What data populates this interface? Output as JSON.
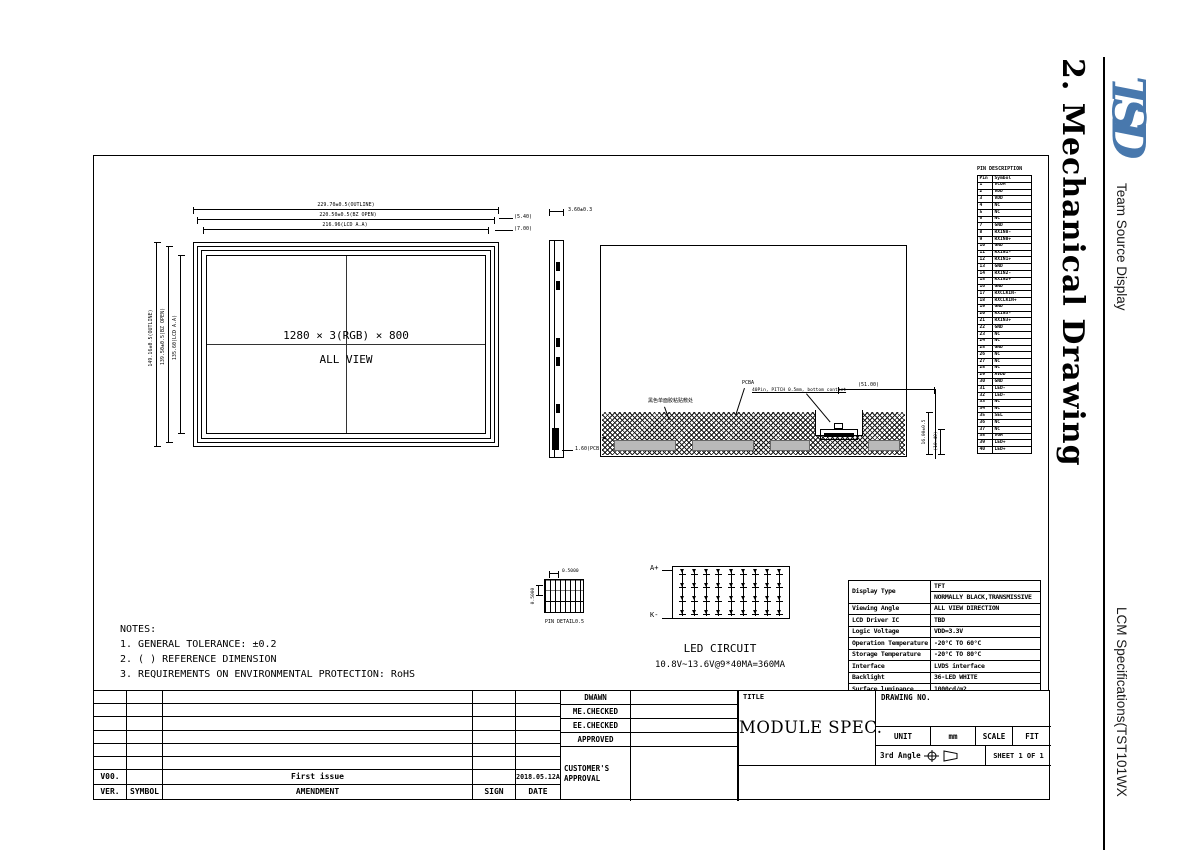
{
  "sidebar": {
    "section_title": "2. Mechanical Drawing",
    "logo_text": "TSD",
    "logo_color": "#4878ad",
    "company": "Team Source Display",
    "doc_title": "LCM Specifications(TST101WX"
  },
  "front_view": {
    "center_line1": "1280 × 3(RGB) × 800",
    "center_line2": "ALL VIEW",
    "dims_top": [
      "229.70±0.5(OUTLINE)",
      "220.50±0.5(BZ OPEN)",
      "216.96(LCD A.A)"
    ],
    "dims_left": [
      "149.16±0.5(OUTLINE)",
      "139.50±0.5(BZ OPEN)",
      "135.60(LCD A.A)"
    ],
    "dims_right": [
      "(5.40)",
      "(7.00)"
    ]
  },
  "side_view": {
    "dim_top": "3.60±0.3",
    "dim_bottom": "1.60(PCB)"
  },
  "back_view": {
    "label_tape": "黑色单面胶粘贴敷处",
    "label_pcba": "PCBA",
    "label_connector": "40Pin, PITCH 0.5mm, bottom contact",
    "dim_connector": "(51.00)",
    "dims_right": [
      "16.00±0.5",
      "(10.40)"
    ]
  },
  "pin_detail": {
    "dim_top": "0.5000",
    "dim_left": "0.5000",
    "caption": "PIN DETAIL0.5"
  },
  "led_circuit": {
    "anode": "A+",
    "cathode": "K-",
    "caption": "LED CIRCUIT",
    "spec": "10.8V~13.6V@9*40MA=360MA",
    "columns": [
      "",
      "",
      "",
      "",
      "",
      "",
      "",
      "",
      ""
    ]
  },
  "notes": {
    "heading": "NOTES:",
    "items": [
      "1. GENERAL TOLERANCE: ±0.2",
      "2. (  ) REFERENCE DIMENSION",
      "3.  REQUIREMENTS ON ENVIRONMENTAL PROTECTION: RoHS"
    ]
  },
  "pin_table": {
    "title": "PIN DESCRIPTION",
    "col_pin": "Pin",
    "col_symbol": "Symbol",
    "rows": [
      {
        "pin": "1",
        "symbol": "VCOM"
      },
      {
        "pin": "2",
        "symbol": "VDD"
      },
      {
        "pin": "3",
        "symbol": "VDD"
      },
      {
        "pin": "4",
        "symbol": "NC"
      },
      {
        "pin": "5",
        "symbol": "NC"
      },
      {
        "pin": "6",
        "symbol": "NC"
      },
      {
        "pin": "7",
        "symbol": "GND"
      },
      {
        "pin": "8",
        "symbol": "RXIN0-"
      },
      {
        "pin": "9",
        "symbol": "RXIN0+"
      },
      {
        "pin": "10",
        "symbol": "GND"
      },
      {
        "pin": "11",
        "symbol": "RXIN1-"
      },
      {
        "pin": "12",
        "symbol": "RXIN1+"
      },
      {
        "pin": "13",
        "symbol": "GND"
      },
      {
        "pin": "14",
        "symbol": "RXIN2-"
      },
      {
        "pin": "15",
        "symbol": "RXIN2+"
      },
      {
        "pin": "16",
        "symbol": "GND"
      },
      {
        "pin": "17",
        "symbol": "RXCLKIN-"
      },
      {
        "pin": "18",
        "symbol": "RXCLKIN+"
      },
      {
        "pin": "19",
        "symbol": "GND"
      },
      {
        "pin": "20",
        "symbol": "RXIN3-"
      },
      {
        "pin": "21",
        "symbol": "RXIN3+"
      },
      {
        "pin": "22",
        "symbol": "GND"
      },
      {
        "pin": "23",
        "symbol": "NC"
      },
      {
        "pin": "24",
        "symbol": "NC"
      },
      {
        "pin": "25",
        "symbol": "GND"
      },
      {
        "pin": "26",
        "symbol": "NC"
      },
      {
        "pin": "27",
        "symbol": "NC"
      },
      {
        "pin": "28",
        "symbol": "NC"
      },
      {
        "pin": "29",
        "symbol": "AVDD"
      },
      {
        "pin": "30",
        "symbol": "GND"
      },
      {
        "pin": "31",
        "symbol": "LED-"
      },
      {
        "pin": "32",
        "symbol": "LED-"
      },
      {
        "pin": "33",
        "symbol": "NC"
      },
      {
        "pin": "34",
        "symbol": "NC"
      },
      {
        "pin": "35",
        "symbol": "SEL"
      },
      {
        "pin": "36",
        "symbol": "NC"
      },
      {
        "pin": "37",
        "symbol": "NC"
      },
      {
        "pin": "38",
        "symbol": "VGH"
      },
      {
        "pin": "39",
        "symbol": "LED+"
      },
      {
        "pin": "40",
        "symbol": "LED+"
      }
    ]
  },
  "spec_table": {
    "display_type_label": "Display Type",
    "display_type_value1": "TFT",
    "display_type_value2": "NORMALLY BLACK,TRANSMISSIVE",
    "rows": [
      {
        "label": "Viewing Angle",
        "value": "ALL VIEW DIRECTION"
      },
      {
        "label": "LCD Driver IC",
        "value": "TBD"
      },
      {
        "label": "Logic Voltage",
        "value": "VDD=3.3V"
      },
      {
        "label": "Operation Temperature",
        "value": "-20°C TO 60°C"
      },
      {
        "label": "Storage Temperature",
        "value": "-20°C TO 80°C"
      },
      {
        "label": "Interface",
        "value": "LVDS interface"
      },
      {
        "label": "Backlight",
        "value": "36-LED WHITE"
      },
      {
        "label": "Surface luminance",
        "value": "1000cd/m2"
      },
      {
        "label": "White X/Y",
        "value": "--"
      }
    ]
  },
  "revision_table": {
    "entry": {
      "ver": "V00.",
      "symbol": "",
      "amendment": "First issue",
      "sign": "",
      "date": "2018.05.12A"
    },
    "header": [
      "VER.",
      "SYMBOL",
      "AMENDMENT",
      "SIGN",
      "DATE"
    ]
  },
  "title_block": {
    "rows": [
      "DWAWN",
      "ME.CHECKED",
      "EE.CHECKED",
      "APPROVED"
    ],
    "customer": "CUSTOMER'S APPROVAL",
    "title_label": "TITLE",
    "title_value": "MODULE SPEC.",
    "drawing_no_label": "DRAWING NO.",
    "unit_label": "UNIT",
    "unit_value": "mm",
    "scale_label": "SCALE",
    "scale_value": "FIT",
    "angle_label": "3rd Angle",
    "sheet_label": "SHEET 1 OF 1"
  }
}
